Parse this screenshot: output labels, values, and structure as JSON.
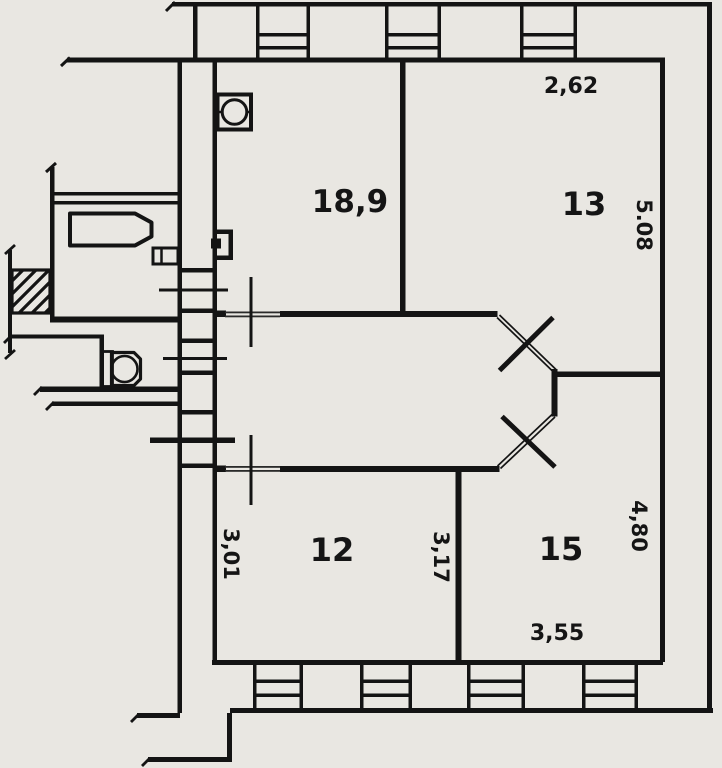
{
  "document": {
    "type": "apartment-floor-plan"
  },
  "colors": {
    "paper": "#e9e7e2",
    "ink": "#141414"
  },
  "labels": {
    "room_18_9": "18,9",
    "room_13": "13",
    "room_12": "12",
    "room_15": "15",
    "dim_top_13": "2,62",
    "dim_right_13": "5.08",
    "dim_left_12": "3,01",
    "dim_mid_12_15": "3,17",
    "dim_right_15": "4,80",
    "dim_bottom_15": "3,55"
  },
  "rooms": [
    {
      "area_m2": "18,9"
    },
    {
      "area_m2": "13",
      "width_m": "2,62",
      "length_m": "5.08"
    },
    {
      "area_m2": "12",
      "length_m": "3,01"
    },
    {
      "area_m2": "15",
      "width_m": "3,55",
      "length_m": "4,80",
      "shared_wall_m": "3,17"
    }
  ],
  "fixtures": [
    "bathtub",
    "toilet",
    "vent",
    "radiator"
  ],
  "features": {
    "top_windows": 3,
    "bottom_windows": 4,
    "door_swings": 2
  }
}
